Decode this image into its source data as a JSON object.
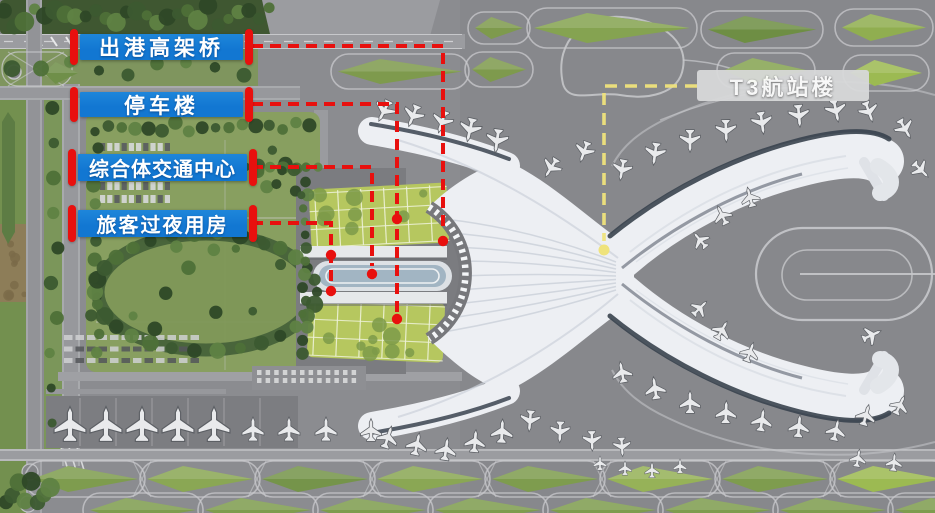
{
  "callouts": [
    {
      "id": "departure-viaduct",
      "label": "出港高架桥"
    },
    {
      "id": "parking-building",
      "label": "停车楼"
    },
    {
      "id": "transport-center",
      "label": "综合体交通中心"
    },
    {
      "id": "passenger-overnight-rooms",
      "label": "旅客过夜用房"
    }
  ],
  "terminal_tag": {
    "label": "T3航站楼"
  },
  "colors": {
    "callout_bg": "#1277d2",
    "callout_text": "#ffffff",
    "bracket_red": "#e8100e",
    "leader_red": "#e8100e",
    "leader_yellow": "#efe37c",
    "terminal_tag_bg": "#d9dadb",
    "terminal_tag_text": "#ffffff"
  }
}
